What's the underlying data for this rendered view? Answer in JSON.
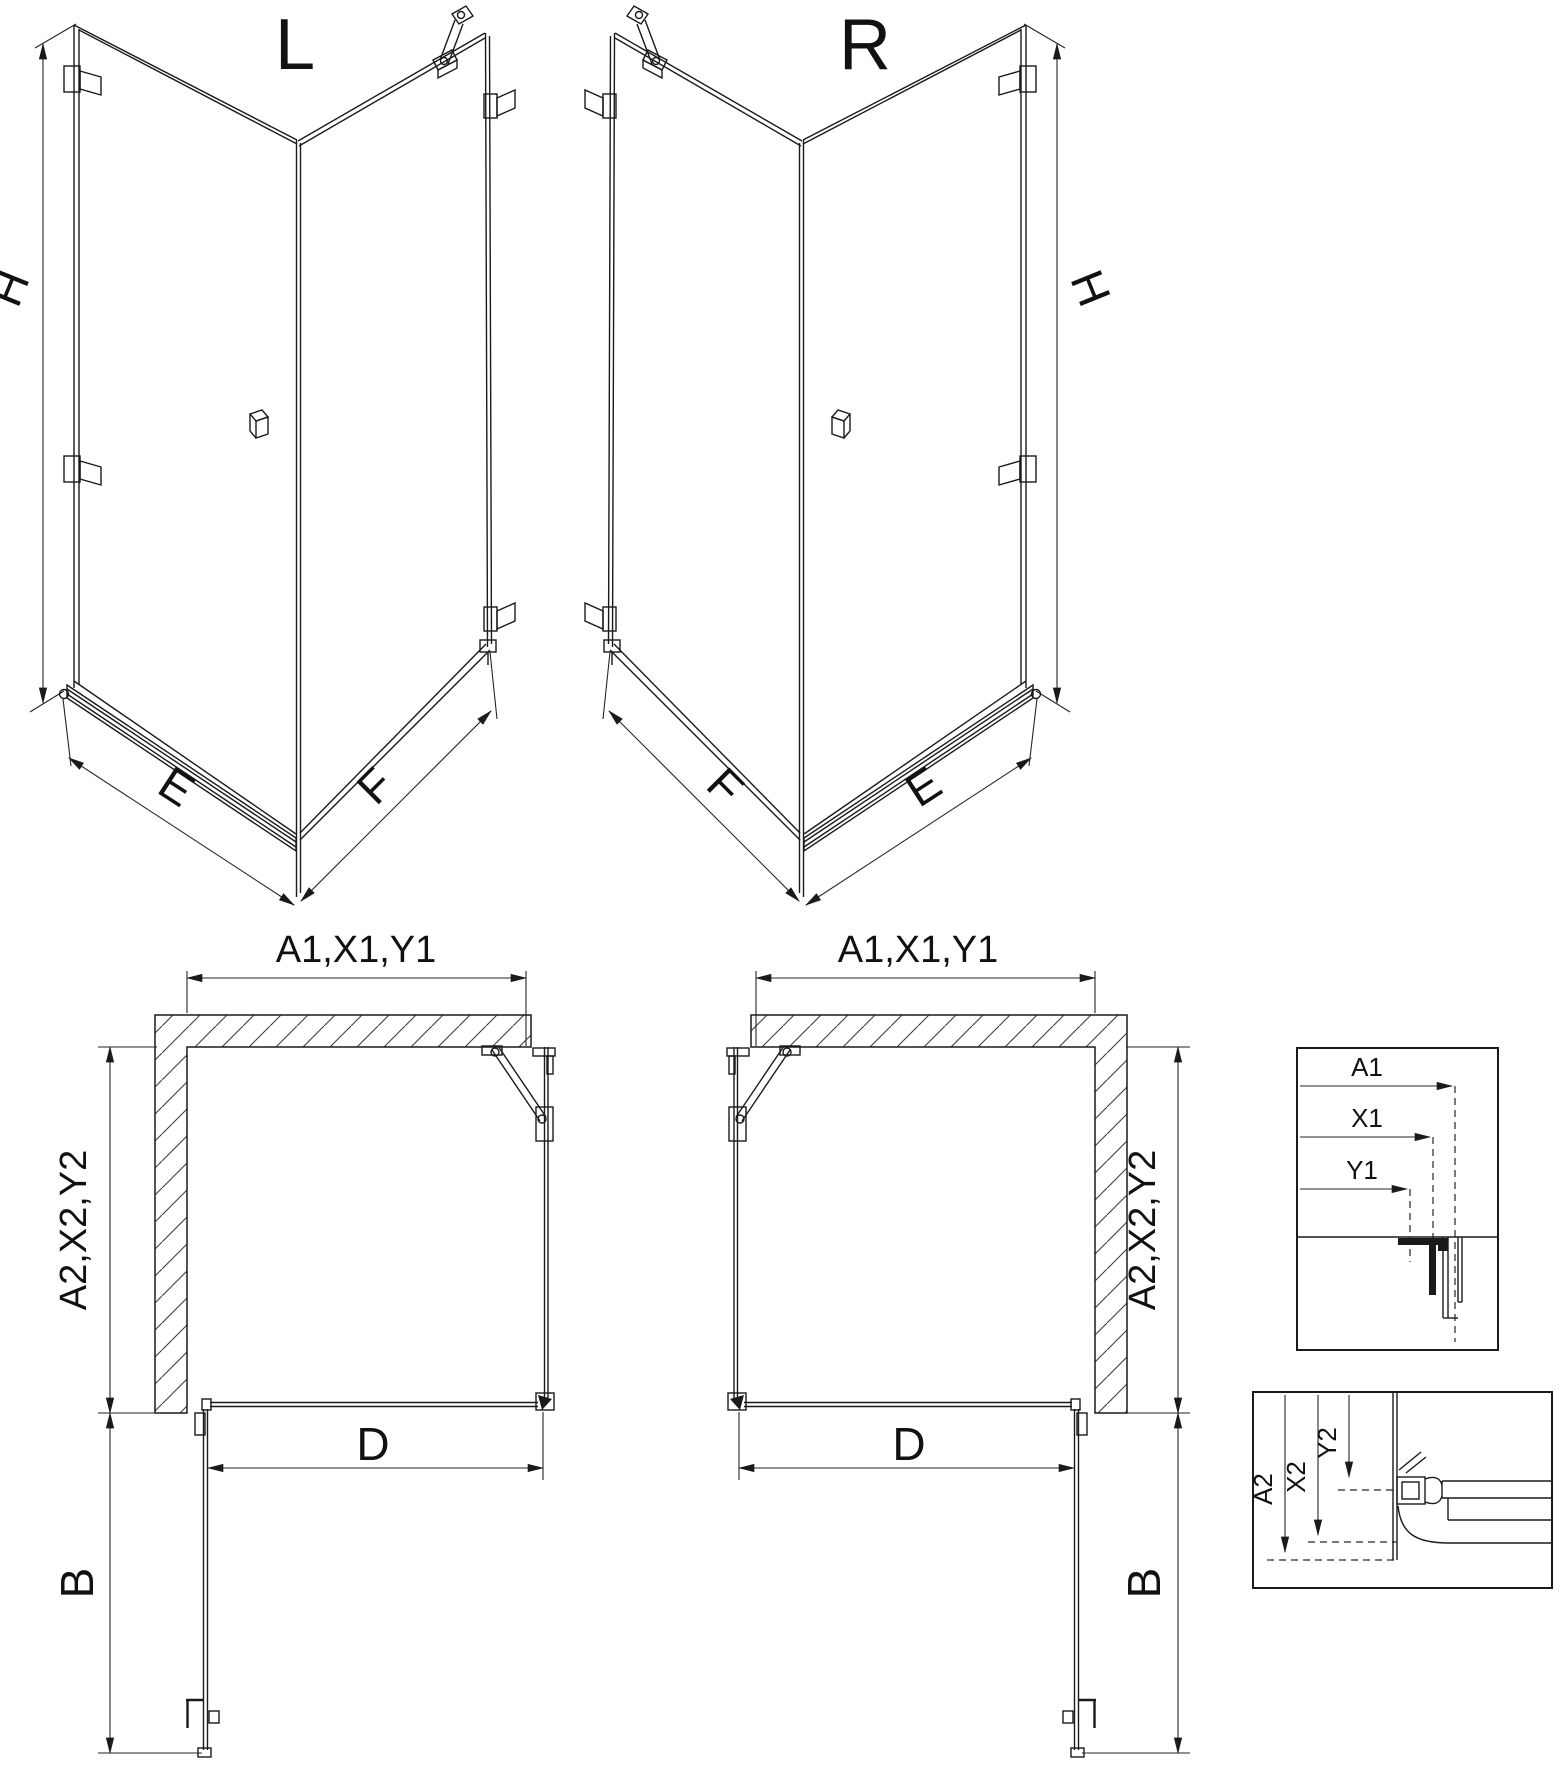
{
  "title": "Shower enclosure technical dimension diagram",
  "colors": {
    "ink": "#1a1a1a",
    "background": "#ffffff"
  },
  "iso_left": {
    "variant_label": "L",
    "height_label": "H",
    "bottom_left_label": "E",
    "bottom_right_label": "F"
  },
  "iso_right": {
    "variant_label": "R",
    "height_label": "H",
    "bottom_left_label": "F",
    "bottom_right_label": "E"
  },
  "plan_left": {
    "width_label": "A1,X1,Y1",
    "depth_label": "A2,X2,Y2",
    "door_width_label": "D",
    "door_swing_label": "B"
  },
  "plan_right": {
    "width_label": "A1,X1,Y1",
    "depth_label": "A2,X2,Y2",
    "door_width_label": "D",
    "door_swing_label": "B"
  },
  "detail_width": {
    "labels": [
      "A1",
      "X1",
      "Y1"
    ]
  },
  "detail_depth": {
    "labels": [
      "A2",
      "X2",
      "Y2"
    ]
  }
}
